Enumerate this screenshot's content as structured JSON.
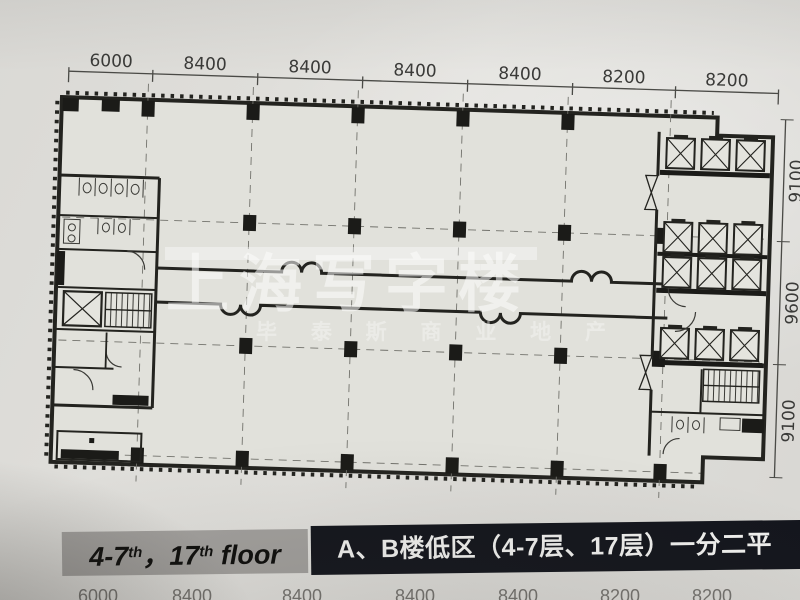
{
  "dimensions": {
    "top": [
      "6000",
      "8400",
      "8400",
      "8400",
      "8400",
      "8200",
      "8200"
    ],
    "right": [
      "9100",
      "9600",
      "9100"
    ],
    "bottom_partial": [
      "6000",
      "8400",
      "8400",
      "8400",
      "8400",
      "8200",
      "8200"
    ]
  },
  "watermark": {
    "brand": "上海写字楼",
    "tagline": "毕泰斯商业地产",
    "tagline_spaced": "毕 泰 斯 商 业 地 产"
  },
  "caption": {
    "floor_range": "4-7",
    "ordinal_1": "th",
    "separator": "，",
    "floor_17": "17",
    "ordinal_2": "th",
    "floor_word": "floor",
    "title": "A、B楼低区（4-7层、17层）一分二平"
  },
  "colors": {
    "paper": "#deddd9",
    "ink": "#23231f",
    "caption_label_bg": "#a3a19e",
    "caption_title_bg": "#14161d",
    "caption_title_text": "#f2f2f0",
    "watermark_white": "rgba(255,255,255,0.5)"
  }
}
